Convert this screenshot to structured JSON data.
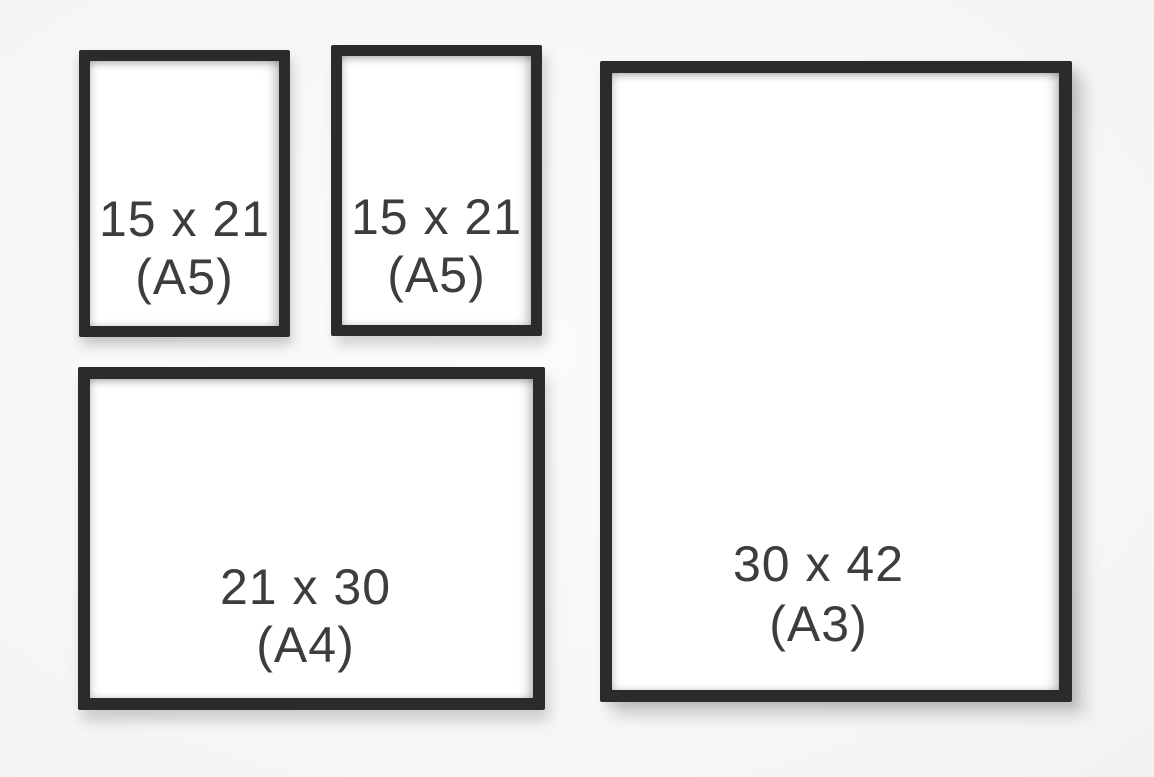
{
  "frames": [
    {
      "id": "a5-left",
      "size": "15 x 21",
      "format": "(A5)"
    },
    {
      "id": "a5-middle",
      "size": "15 x 21",
      "format": "(A5)"
    },
    {
      "id": "a4-bottom",
      "size": "21 x 30",
      "format": "(A4)"
    },
    {
      "id": "a3-right",
      "size": "30 x 42",
      "format": "(A3)"
    }
  ],
  "colors": {
    "background": "#f7f7f7",
    "frame_border": "#2b2b2b",
    "paper": "#ffffff",
    "text": "#3d3d3d"
  }
}
